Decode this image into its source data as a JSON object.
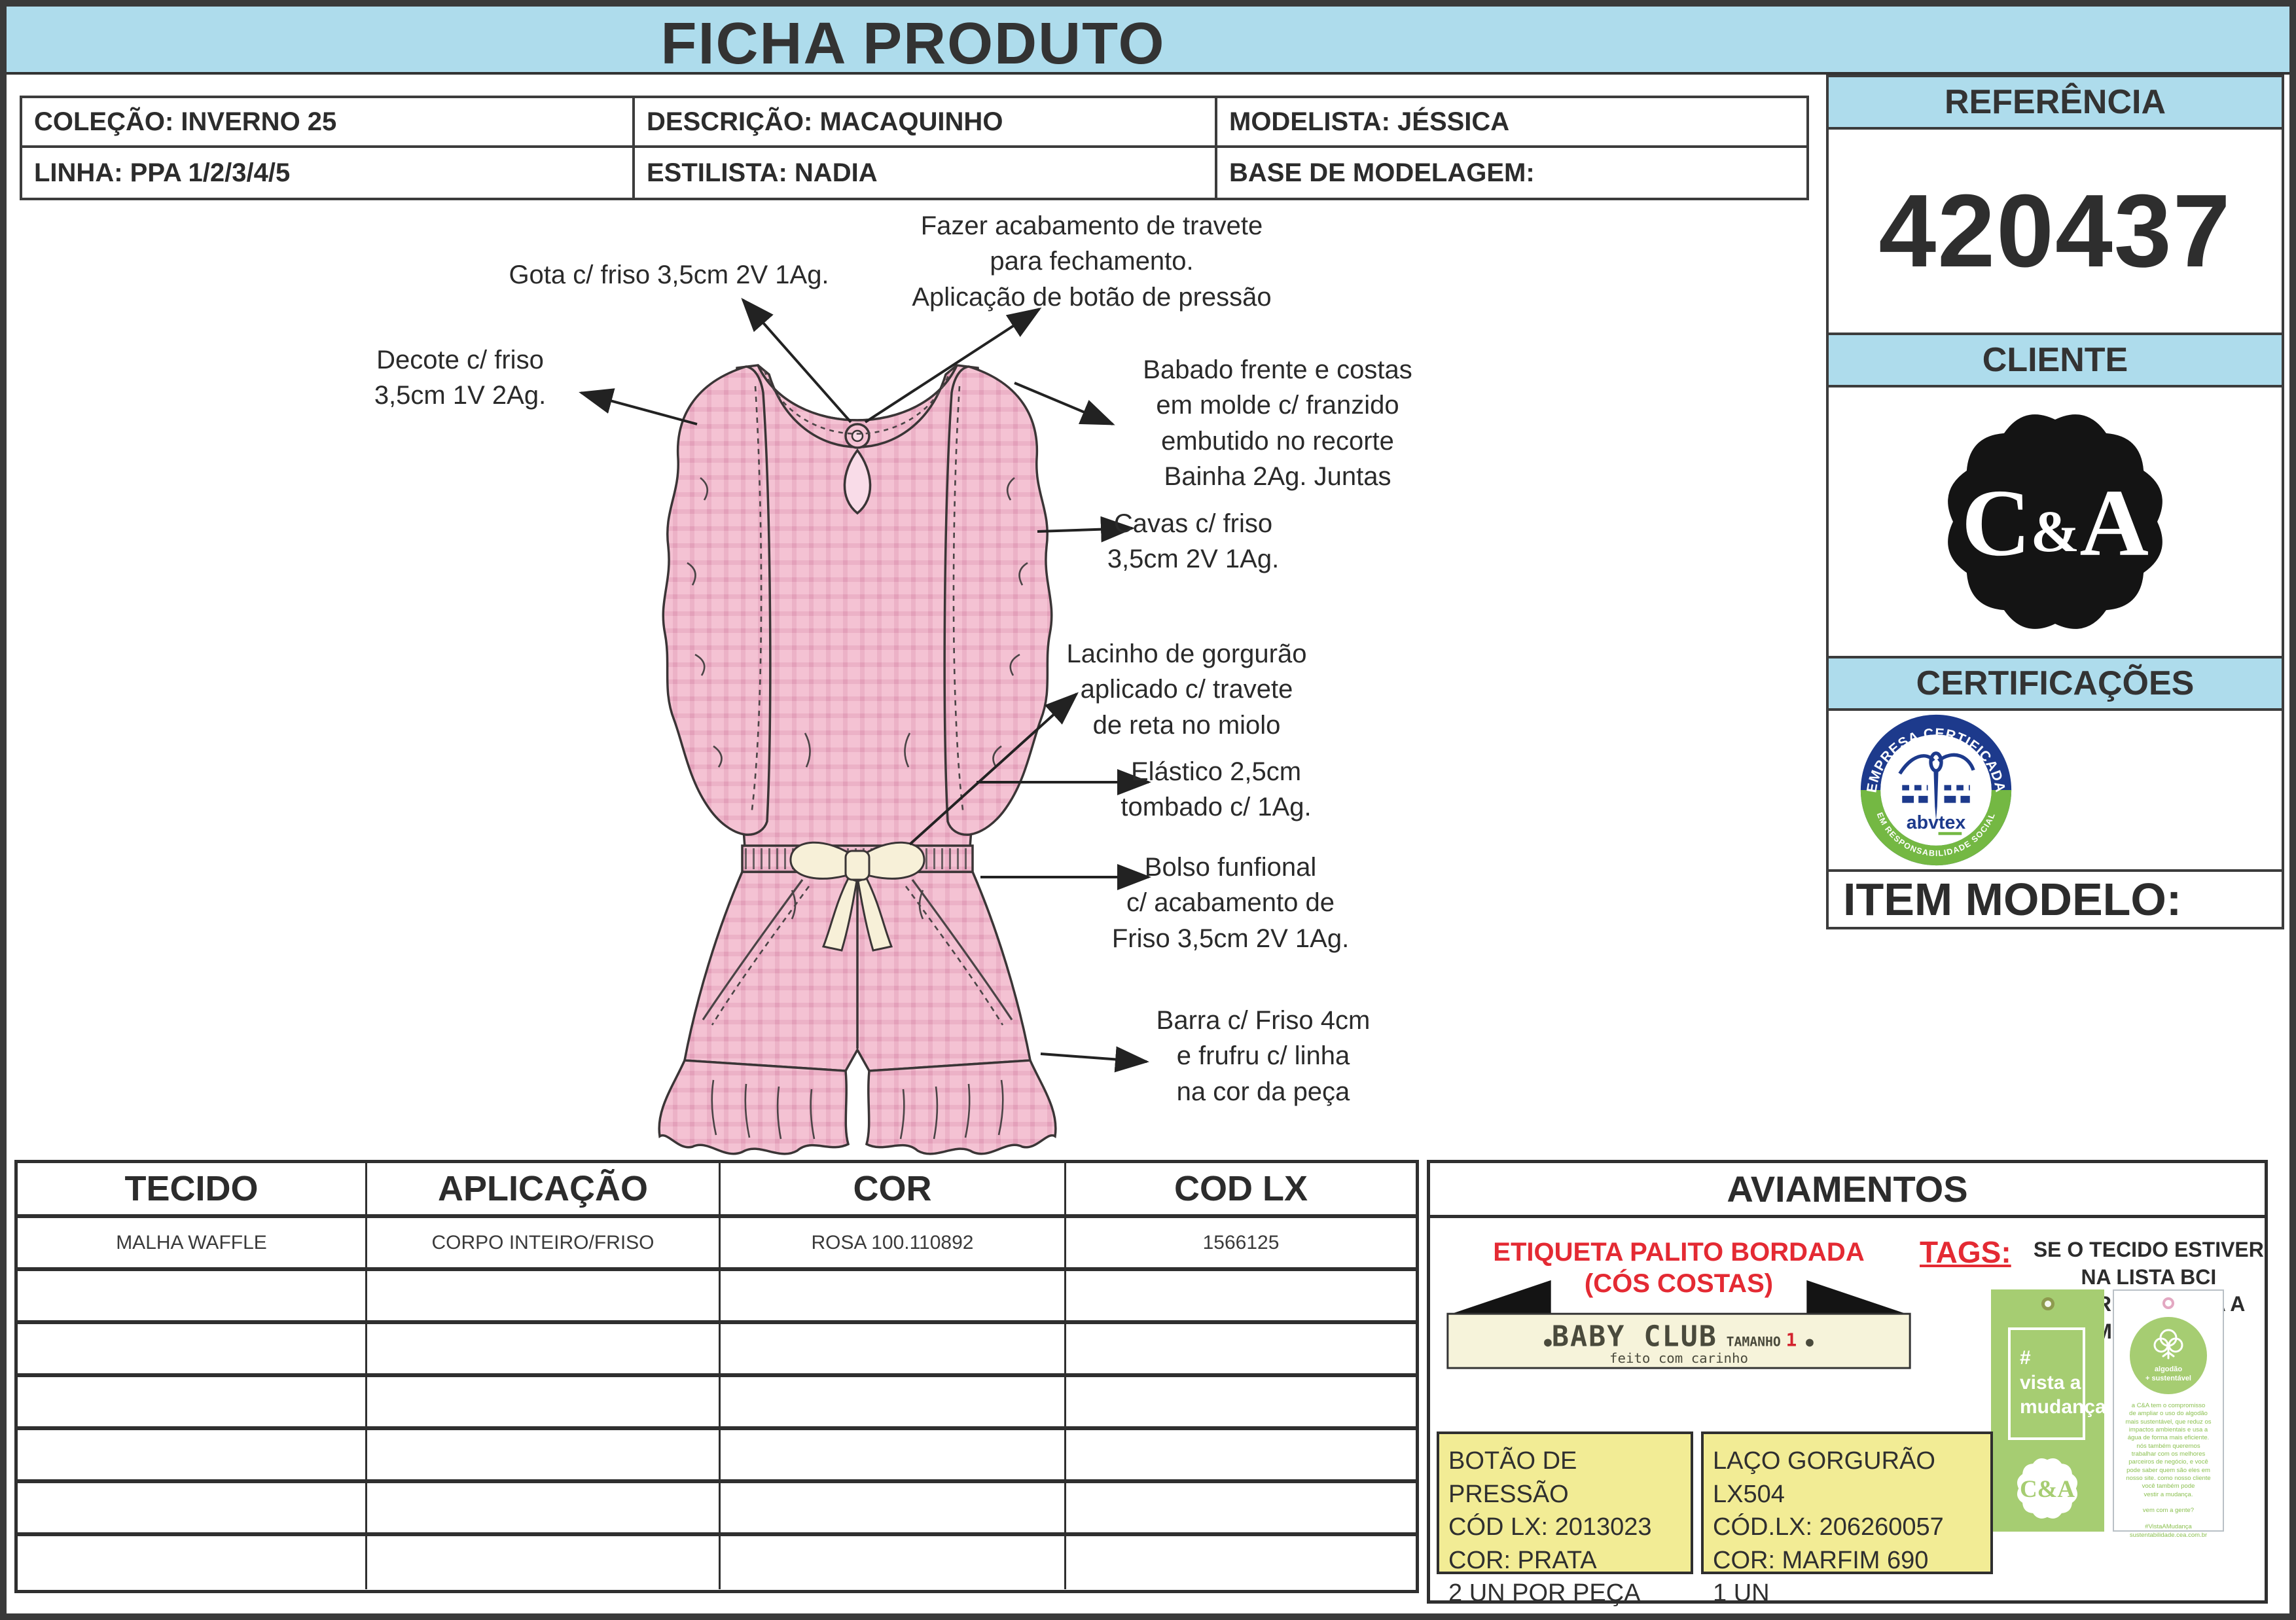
{
  "title": "FICHA PRODUTO",
  "header": {
    "colecao": "COLEÇÃO: INVERNO 25",
    "descricao": "DESCRIÇÃO: MACAQUINHO",
    "modelista": "MODELISTA: JÉSSICA",
    "linha": "LINHA: PPA 1/2/3/4/5",
    "estilista": "ESTILISTA: NADIA",
    "base": "BASE DE MODELAGEM:"
  },
  "sidebar": {
    "referencia_label": "REFERÊNCIA",
    "referencia_value": "420437",
    "cliente_label": "CLIENTE",
    "ca": {
      "c": "C",
      "amp": "&",
      "a": "A"
    },
    "certificacoes_label": "CERTIFICAÇÕES",
    "abvtex": {
      "arc_top": "EMPRESA CERTIFICADA",
      "arc_bottom": "EM RESPONSABILIDADE SOCIAL",
      "name": "abvtex"
    },
    "item_modelo_label": "ITEM MODELO:"
  },
  "annotations": {
    "gota": "Gota c/ friso 3,5cm 2V 1Ag.",
    "fazer": "Fazer acabamento de travete\npara fechamento.\nAplicação de botão de pressão",
    "decote": "Decote c/ friso\n3,5cm 1V 2Ag.",
    "babado": "Babado frente e costas\nem molde c/ franzido\nembutido no recorte\nBainha 2Ag. Juntas",
    "cavas": "Cavas c/ friso\n3,5cm 2V 1Ag.",
    "lacinho": "Lacinho de gorgurão\naplicado c/ travete\nde reta no miolo",
    "elastico": "Elástico 2,5cm\ntombado c/ 1Ag.",
    "bolso": "Bolso funfional\nc/ acabamento de\nFriso 3,5cm 2V 1Ag.",
    "barra": "Barra c/ Friso 4cm\ne frufru c/ linha\nna cor da peça"
  },
  "table": {
    "headers": [
      "TECIDO",
      "APLICAÇÃO",
      "COR",
      "COD LX"
    ],
    "row1": [
      "MALHA WAFFLE",
      "CORPO INTEIRO/FRISO",
      "ROSA 100.110892",
      "1566125"
    ]
  },
  "aviamentos": {
    "title": "AVIAMENTOS",
    "etiqueta_title": "ETIQUETA PALITO BORDADA\n(CÓS COSTAS)",
    "label": {
      "dot_left": "●",
      "brand": "BABY CLUB",
      "tamanho": "TAMANHO",
      "size": "1",
      "dot_right": "●",
      "tagline": "feito com carinho"
    },
    "tags_label": "TAGS:",
    "tags_text": "SE O TECIDO ESTIVER NA LISTA BCI\nUSAR TAG VISTA A MUDANÇA",
    "tag_green": {
      "text": "#\nvista a\nmudança",
      "logo": "C&A"
    },
    "tag_white": {
      "circle_line1": "algodão",
      "circle_line2": "+ sustentável",
      "body": "a C&A tem o compromisso\nde ampliar o uso do algodão\nmais sustentável, que reduz os\nimpactos ambientais e usa a\nágua de forma mais eficiente.\nnós também queremos\ntrabalhar com os melhores\nparceiros de negócio, e você\npode saber quem são eles em\nnosso site. como nosso cliente\nvocê também pode\nvestir a mudança.\n\nvem com a gente?\n\n#VistaAMudança\nsustentabilidade.cea.com.br"
    },
    "botao_box": "BOTÃO DE PRESSÃO\nCÓD LX: 2013023\nCOR: PRATA\n2 UN POR PEÇA",
    "laco_box": "LAÇO GORGURÃO LX504\nCÓD.LX: 206260057\nCOR: MARFIM 690\n1 UN"
  },
  "colors": {
    "header_blue": "#aedcec",
    "garment_pink": "#f4c2d3",
    "plaid_line": "#eaaec4",
    "note_yellow": "#f2ec95",
    "brand_green": "#a6cd72",
    "alert_red": "#e42a33",
    "abvtex_blue": "#1d3a8c",
    "abvtex_green": "#74b843"
  }
}
